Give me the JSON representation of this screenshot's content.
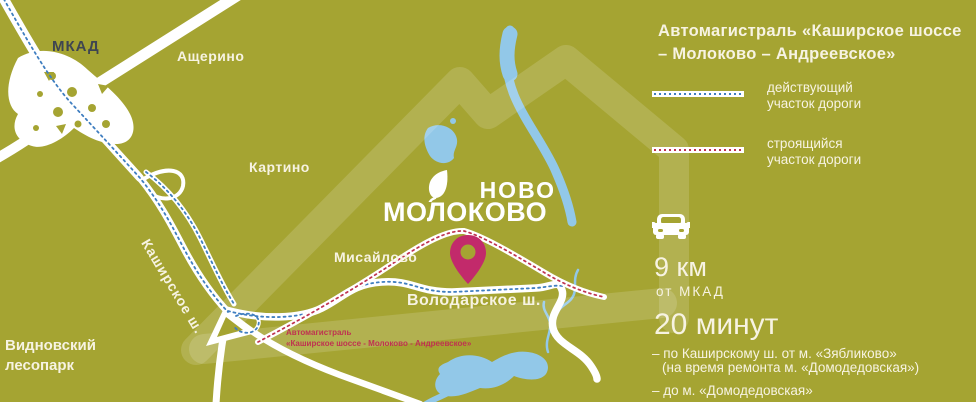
{
  "colors": {
    "background": "#a5a432",
    "road": "#ffffff",
    "water": "#92c8e8",
    "route_existing": "#3f7ec0",
    "route_construction": "#bf3350",
    "pin": "#c22a6b",
    "text_light": "#f7f3e2",
    "text_dark": "#3e4551"
  },
  "icons": {
    "pin": "location-pin-icon",
    "car": "car-icon",
    "leaf": "leaf-icon"
  },
  "map": {
    "labels": {
      "mkad": "МКАД",
      "ascherino": "Ащерино",
      "kartino": "Картино",
      "misaylovo": "Мисайлово",
      "kashirskoe": "Каширское ш.",
      "volodarskoe": "Володарское ш.",
      "lesopark_line1": "Видновский",
      "lesopark_line2": "лесопарк",
      "rednote_line1": "Автомагистраль",
      "rednote_line2": "«Каширское шоссе - Молоково - Андреевское»"
    },
    "logo": {
      "line1": "НОВО",
      "line2": "МОЛОКОВО"
    }
  },
  "panel": {
    "title_line1": "Автомагистраль «Каширское шоссе",
    "title_line2": "– Молоково – Андреевское»",
    "legend": [
      {
        "line1": "действующий",
        "line2": "участок дороги"
      },
      {
        "line1": "строящийся",
        "line2": "участок дороги"
      }
    ],
    "distance": {
      "value": "9 км",
      "sub": "от МКАД"
    },
    "time": {
      "value": "20 минут",
      "note1": "– по Каширскому ш. от м. «Зябликово»",
      "note2": "(на время ремонта м. «Домодедовская»)",
      "note3": "– до м. «Домодедовская»"
    }
  }
}
